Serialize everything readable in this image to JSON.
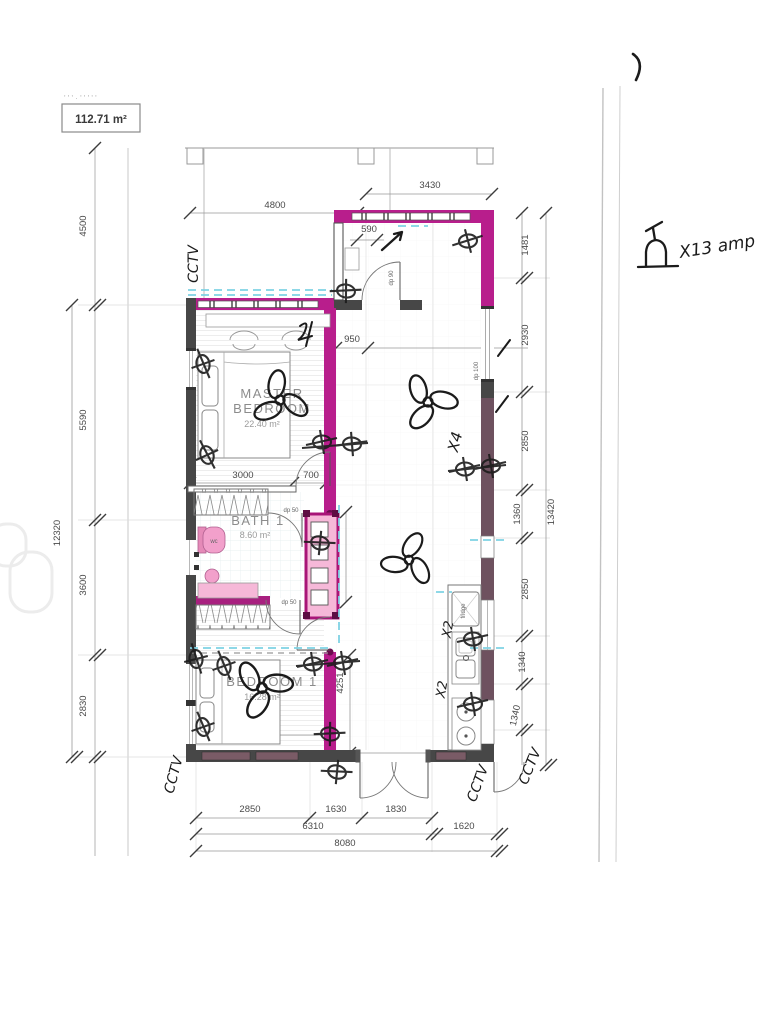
{
  "area_box": {
    "value": "112.71 m²",
    "faded_marks": "' ' ' · ' ' ' ' '"
  },
  "rooms": {
    "master": {
      "line1": "MASTER",
      "line2": "BEDROOM",
      "area": "22.40 m²"
    },
    "bath": {
      "name": "BATH 1",
      "area": "8.60 m²"
    },
    "bedroom1": {
      "name": "BEDROOM 1",
      "area": "16.28 m²"
    }
  },
  "dims": {
    "top4800": "4800",
    "top3430": "3430",
    "entry590": "590",
    "master950": "950",
    "left4500": "4500",
    "left5590": "5590",
    "left12320": "12320",
    "left3600": "3600",
    "left2830": "2830",
    "right1481": "1481",
    "right2930": "2930",
    "right2850a": "2850",
    "right1360": "1360",
    "right13420": "13420",
    "right2850b": "2850",
    "right1340a": "1340",
    "right1340b": "1340",
    "in3000": "3000",
    "in700": "700",
    "in2110": "2110",
    "in4251": "4251",
    "in3550": "3550",
    "bot2850": "2850",
    "bot1630": "1630",
    "bot1830": "1830",
    "bot6310": "6310",
    "bot1620": "1620",
    "bot8080": "8080"
  },
  "fixture_labels": {
    "dp90": "dp 90",
    "dp50a": "dp 50",
    "dp50b": "dp 50",
    "dp100": "dp 100",
    "fridge": "fridge",
    "wc": "wc"
  },
  "handwritten": {
    "cctv_top_left": "CCTV",
    "cctv_bottom_left": "CCTV",
    "cctv_bottom_door": "CCTV",
    "cctv_bottom_right": "CCTV",
    "fan_count": "X4",
    "socket_count_a": "X2",
    "socket_count_b": "X2",
    "amp_note": "X13 amp"
  },
  "colors": {
    "wall_highlight": "#b81e8c",
    "pink_fill": "#f6b8d8",
    "wall_dark": "#474747",
    "wall_maroon": "#6e515f",
    "cyan_dash": "#7fd2e4",
    "ink": "#1b1b1b"
  }
}
